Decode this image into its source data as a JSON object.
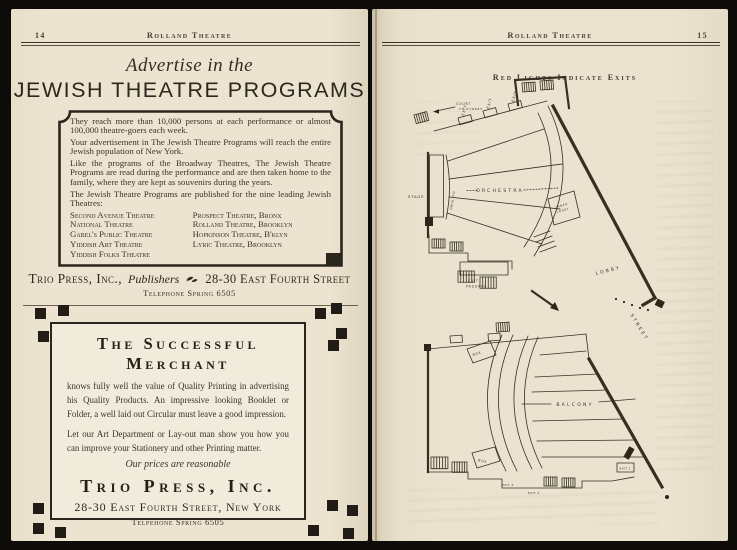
{
  "running_title": "Rolland Theatre",
  "colors": {
    "paper": "#ece4d0",
    "ink": "#2f2a22",
    "frame": "#0e0c09"
  },
  "left_page": {
    "page_number": "14",
    "ad_programs": {
      "heading_script": "Advertise in the",
      "heading_main": "JEWISH THEATRE PROGRAMS",
      "paragraphs": [
        "They reach more than 10,000 persons at each performance or almost 100,000 theatre-goers each week.",
        "Your advertisement in The Jewish Theatre Programs will reach the entire Jewish population of New York.",
        "Like the programs of the Broadway Theatres, The Jewish Theatre Programs are read during the performance and are then taken home to the family, where they are kept as souvenirs during the years.",
        "The Jewish Theatre Programs are published for the nine leading Jewish Theatres:"
      ],
      "theatres_left": [
        "Second Avenue Theatre",
        "National Theatre",
        "Gabel's Public Theatre",
        "Yiddish Art Theatre",
        "Yiddish Folks Theatre"
      ],
      "theatres_right": [
        "Prospect Theatre, Bronx",
        "Rolland Theatre, Brooklyn",
        "Hopkinson Theatre, B'klyn",
        "Lyric Theatre, Brooklyn"
      ],
      "publisher_name": "Trio Press, Inc.,",
      "publisher_role": "Publishers",
      "publisher_address": "28-30 East Fourth Street",
      "publisher_phone": "Telephone Spring 6505"
    },
    "ad_merchant": {
      "heading": "The Successful Merchant",
      "body_1": "knows fully well the value of Quality Printing in advertising his Quality Products.  An impressive looking Booklet or Folder, a well laid out Circular must leave a good impression.",
      "body_2": "Let our Art Department or Lay-out man show you how you can improve your Stationery and other Printing matter.",
      "tagline": "Our prices are reasonable",
      "company": "Trio Press, Inc.",
      "address": "28-30 East Fourth Street, New York",
      "phone": "Telpehone Spring 6505"
    }
  },
  "right_page": {
    "page_number": "15",
    "caption": "Red Lights Indicate Exits",
    "plan": {
      "court_1": "COURT",
      "court_2": "TO STREET",
      "exit": "EXIT",
      "stage": "STAGE",
      "orch_pit": "ORCH. PIT",
      "orchestra": "ORCHESTRA",
      "exit_passage_1": "EXIT",
      "exit_passage_2": "PASSAGE",
      "inner_lobby_1": "INNER",
      "inner_lobby_2": "LOBBY",
      "lobby": "LOBBY",
      "street": "STREET",
      "balcony": "BALCONY",
      "box": "BOX",
      "exit_4": "EXIT 4",
      "exit_3": "EXIT 3",
      "exit_1": "EXIT 1"
    }
  }
}
